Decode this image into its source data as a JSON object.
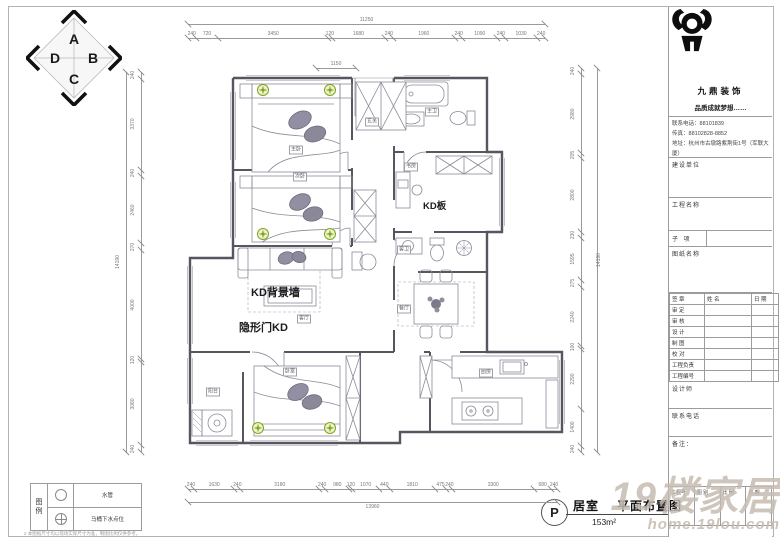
{
  "compass": {
    "letters": {
      "top": "A",
      "right": "B",
      "bottom": "C",
      "left": "D"
    }
  },
  "plan": {
    "labels": [
      {
        "text": "KD板",
        "x": 423,
        "y": 198,
        "size": 9.5
      },
      {
        "text": "KD背景墙",
        "x": 251,
        "y": 284,
        "size": 11
      },
      {
        "text": "隐形门KD",
        "x": 239,
        "y": 319,
        "size": 11
      }
    ],
    "room_tags": [
      {
        "text": "主卧",
        "x": 296,
        "y": 150
      },
      {
        "text": "次卧",
        "x": 300,
        "y": 177
      },
      {
        "text": "客厅",
        "x": 304,
        "y": 319
      },
      {
        "text": "餐厅",
        "x": 404,
        "y": 309
      },
      {
        "text": "厨房",
        "x": 486,
        "y": 373
      },
      {
        "text": "主卫",
        "x": 432,
        "y": 112
      },
      {
        "text": "客卫",
        "x": 404,
        "y": 250
      },
      {
        "text": "书房",
        "x": 411,
        "y": 167
      },
      {
        "text": "阳台",
        "x": 213,
        "y": 392
      },
      {
        "text": "玄关",
        "x": 372,
        "y": 122
      },
      {
        "text": "卧室",
        "x": 290,
        "y": 372
      }
    ]
  },
  "dimensions": {
    "chains": [
      {
        "name": "top",
        "dir": "h",
        "x": 188,
        "y": 38,
        "len": 357,
        "total": "11250",
        "total_offset": 24,
        "segments": [
          "240",
          "720",
          "3450",
          "120",
          "1680",
          "240",
          "1960",
          "240",
          "1090",
          "240",
          "1030",
          "240"
        ]
      },
      {
        "name": "top-entry",
        "dir": "h",
        "x": 316,
        "y": 68,
        "len": 40,
        "segments": [
          "1150"
        ]
      },
      {
        "name": "bottom",
        "dir": "h",
        "x": 188,
        "y": 489,
        "len": 369,
        "total": "13960",
        "total_offset": 502,
        "segments": [
          "240",
          "1630",
          "240",
          "3180",
          "240",
          "980",
          "120",
          "1070",
          "440",
          "1810",
          "475",
          "240",
          "3300",
          "680",
          "240"
        ]
      },
      {
        "name": "left",
        "dir": "v",
        "x": 141,
        "y": 72,
        "len": 380,
        "total": "14190",
        "total_offset": 126,
        "segments": [
          "240",
          "3370",
          "240",
          "2460",
          "270",
          "4000",
          "120",
          "3080",
          "240"
        ]
      },
      {
        "name": "right",
        "dir": "v",
        "x": 581,
        "y": 68,
        "len": 384,
        "total": "14190",
        "total_offset": 597,
        "segments": [
          "240",
          "2980",
          "205",
          "2800",
          "230",
          "1595",
          "275",
          "2240",
          "100",
          "2290",
          "1400",
          "240"
        ]
      }
    ]
  },
  "titleblock": {
    "company": "九鼎装饰",
    "slogan": "品质成就梦想……",
    "phone_label": "联系电话：",
    "phone": "88101839",
    "fax_label": "传真：",
    "fax": "88102828-8852",
    "address_label": "地址：",
    "address": "杭州市古墩路紫荆街1号（军联大厦）",
    "field_owner": "建设单位",
    "field_project": "工程名称",
    "field_subitem": "子 项",
    "field_drawing": "图纸名称",
    "sign_table": {
      "header": [
        "签 章",
        "姓 名",
        "日 期"
      ],
      "rows": [
        "审 定",
        "审 核",
        "设 计",
        "制 图",
        "校 对",
        "工程负责",
        "工程编号"
      ]
    },
    "designer_label": "设计师",
    "phone2_label": "联系电话",
    "notes_label": "备注：",
    "footer_cells": [
      "工程号",
      "图 别",
      "比 例",
      "日 期"
    ]
  },
  "legend": {
    "title_chars": [
      "图",
      "例"
    ],
    "rows": [
      {
        "icon": "circle",
        "label": "水管"
      },
      {
        "icon": "circle-cross",
        "label": "马桶下水点位"
      }
    ],
    "note": "2 本图纸尺寸均以现场实际尺寸为准，制图比例仅供参考。"
  },
  "sheet": {
    "code": "P",
    "room_label": "居室",
    "drawing_title": "平面布置图",
    "area": "153m²"
  },
  "watermark": {
    "text": "19楼家居",
    "url": "home.19lou.com"
  },
  "colors": {
    "wall": "#565660",
    "furniture": "#8b8b98",
    "dims": "#8a8a8a",
    "green": "#7fa31d",
    "watermark": "#c6bcb1"
  }
}
